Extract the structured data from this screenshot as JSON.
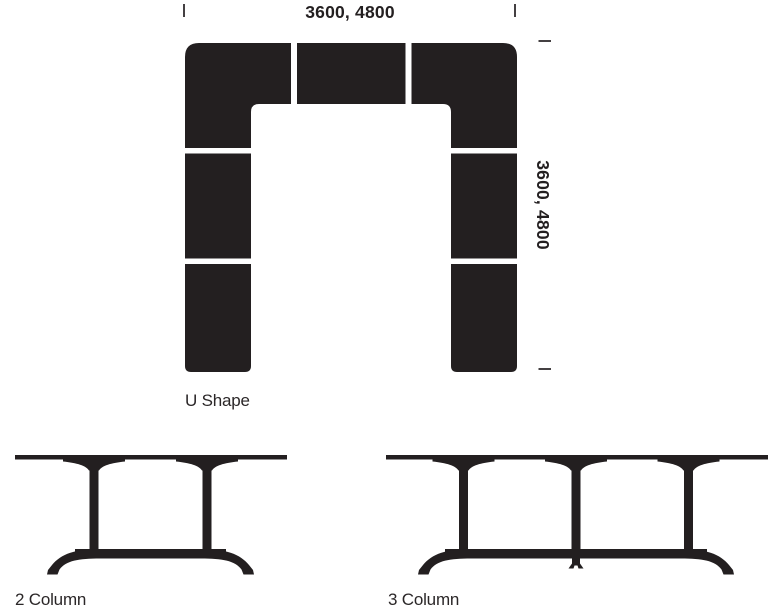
{
  "colors": {
    "ink": "#231f20",
    "caption_text": "#2b2728",
    "background": "#ffffff"
  },
  "u_shape": {
    "label": "U Shape",
    "top_dimension": "3600, 4800",
    "side_dimension": "3600, 4800"
  },
  "tables": [
    {
      "label": "2 Column"
    },
    {
      "label": "3 Column"
    }
  ]
}
